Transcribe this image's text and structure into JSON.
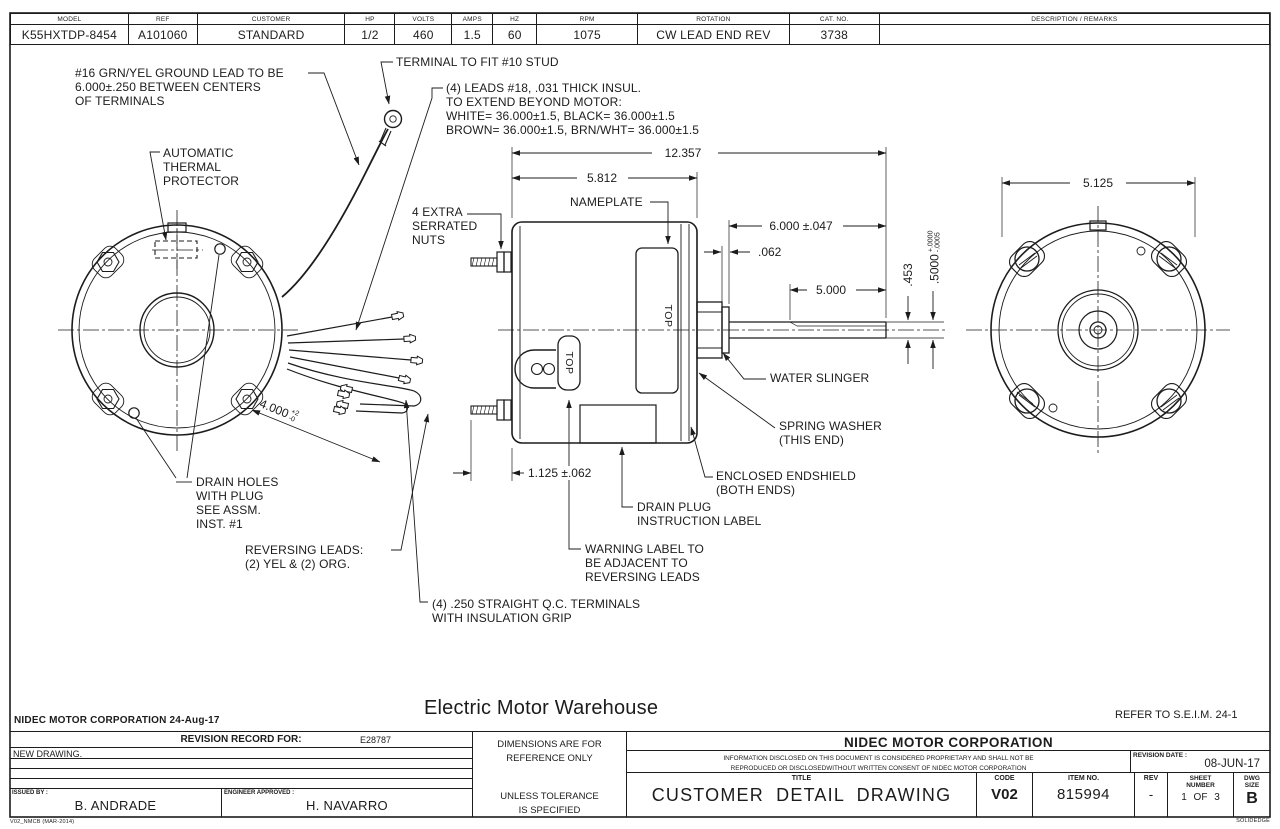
{
  "spec_table": {
    "columns": [
      {
        "label": "MODEL",
        "value": "K55HXTDP-8454"
      },
      {
        "label": "REF",
        "value": "A101060"
      },
      {
        "label": "CUSTOMER",
        "value": "STANDARD"
      },
      {
        "label": "HP",
        "value": "1/2"
      },
      {
        "label": "VOLTS",
        "value": "460"
      },
      {
        "label": "AMPS",
        "value": "1.5"
      },
      {
        "label": "HZ",
        "value": "60"
      },
      {
        "label": "RPM",
        "value": "1075"
      },
      {
        "label": "ROTATION",
        "value": "CW LEAD END REV"
      },
      {
        "label": "CAT. NO.",
        "value": "3738"
      },
      {
        "label": "DESCRIPTION / REMARKS",
        "value": ""
      }
    ]
  },
  "callouts": {
    "ground_lead": "#16 GRN/YEL GROUND LEAD TO BE\n6.000±.250 BETWEEN CENTERS\nOF TERMINALS",
    "terminal_stud": "TERMINAL TO FIT #10 STUD",
    "leads_note": "(4) LEADS #18, .031 THICK INSUL.\nTO EXTEND BEYOND MOTOR:\nWHITE= 36.000±1.5, BLACK= 36.000±1.5\nBROWN= 36.000±1.5, BRN/WHT= 36.000±1.5",
    "thermal_protector": "AUTOMATIC\nTHERMAL\nPROTECTOR",
    "extra_nuts": "4 EXTRA\nSERRATED\nNUTS",
    "nameplate": "NAMEPLATE",
    "water_slinger": "WATER SLINGER",
    "spring_washer": "SPRING WASHER\n(THIS END)",
    "endshield": "ENCLOSED ENDSHIELD\n(BOTH ENDS)",
    "drain_plug": "DRAIN PLUG\nINSTRUCTION LABEL",
    "warning_label": "WARNING LABEL TO\nBE ADJACENT TO\nREVERSING LEADS",
    "drain_holes": "DRAIN HOLES\nWITH PLUG\nSEE ASSM.\nINST. #1",
    "reversing_leads": "REVERSING LEADS:\n(2) YEL & (2) ORG.",
    "qc_terminals": "(4) .250 STRAIGHT Q.C. TERMINALS\nWITH INSULATION GRIP",
    "top_label": "TOP"
  },
  "dimensions": {
    "overall_length": "12.357",
    "body_length": "5.812",
    "shaft_ext": "6.000 ±.047",
    "slinger_width": ".062",
    "shaft_flat": "5.000",
    "shaft_dia_1": ".453",
    "shaft_dia_2": ".5000",
    "shaft_dia_2_tol_plus": "+.0000",
    "shaft_dia_2_tol_minus": "-.0005",
    "stud_length": "1.125 ±.062",
    "bolt_circle": "5.125",
    "lead_bundle": "4.000",
    "lead_bundle_tol_plus": "+2",
    "lead_bundle_tol_minus": "-0"
  },
  "watermark": "Electric Motor Warehouse",
  "footer": {
    "issuer_line": "NIDEC MOTOR CORPORATION 24-Aug-17",
    "refer_note": "REFER TO S.E.I.M. 24-1",
    "revision_record_label": "REVISION RECORD FOR:",
    "revision_record_number": "E28787",
    "revision_note": "NEW DRAWING.",
    "issued_by_label": "ISSUED BY :",
    "issued_by": "B. ANDRADE",
    "engineer_label": "ENGINEER APPROVED :",
    "engineer": "H. NAVARRO",
    "dims_reference": "DIMENSIONS ARE FOR\nREFERENCE ONLY",
    "tolerance_note": "UNLESS TOLERANCE\nIS SPECIFIED",
    "company": "NIDEC MOTOR CORPORATION",
    "proprietary": "INFORMATION DISCLOSED ON THIS DOCUMENT IS CONSIDERED PROPRIETARY AND SHALL NOT BE\nREPRODUCED OR DISCLOSEDWITHOUT WRITTEN CONSENT OF NIDEC MOTOR CORPORATION",
    "revision_date_label": "REVISION DATE :",
    "revision_date": "08-JUN-17",
    "title_label": "TITLE",
    "title": "CUSTOMER DETAIL DRAWING",
    "code_label": "CODE",
    "code": "V02",
    "item_label": "ITEM NO.",
    "item": "815994",
    "rev_label": "REV",
    "rev": "-",
    "sheet_label": "SHEET\nNUMBER",
    "sheet": "1 OF 3",
    "size_label": "DWG\nSIZE",
    "size": "B",
    "form_id": "V02_NMCB (MAR-2014)",
    "cad_note": "SOLIDEDGE"
  }
}
